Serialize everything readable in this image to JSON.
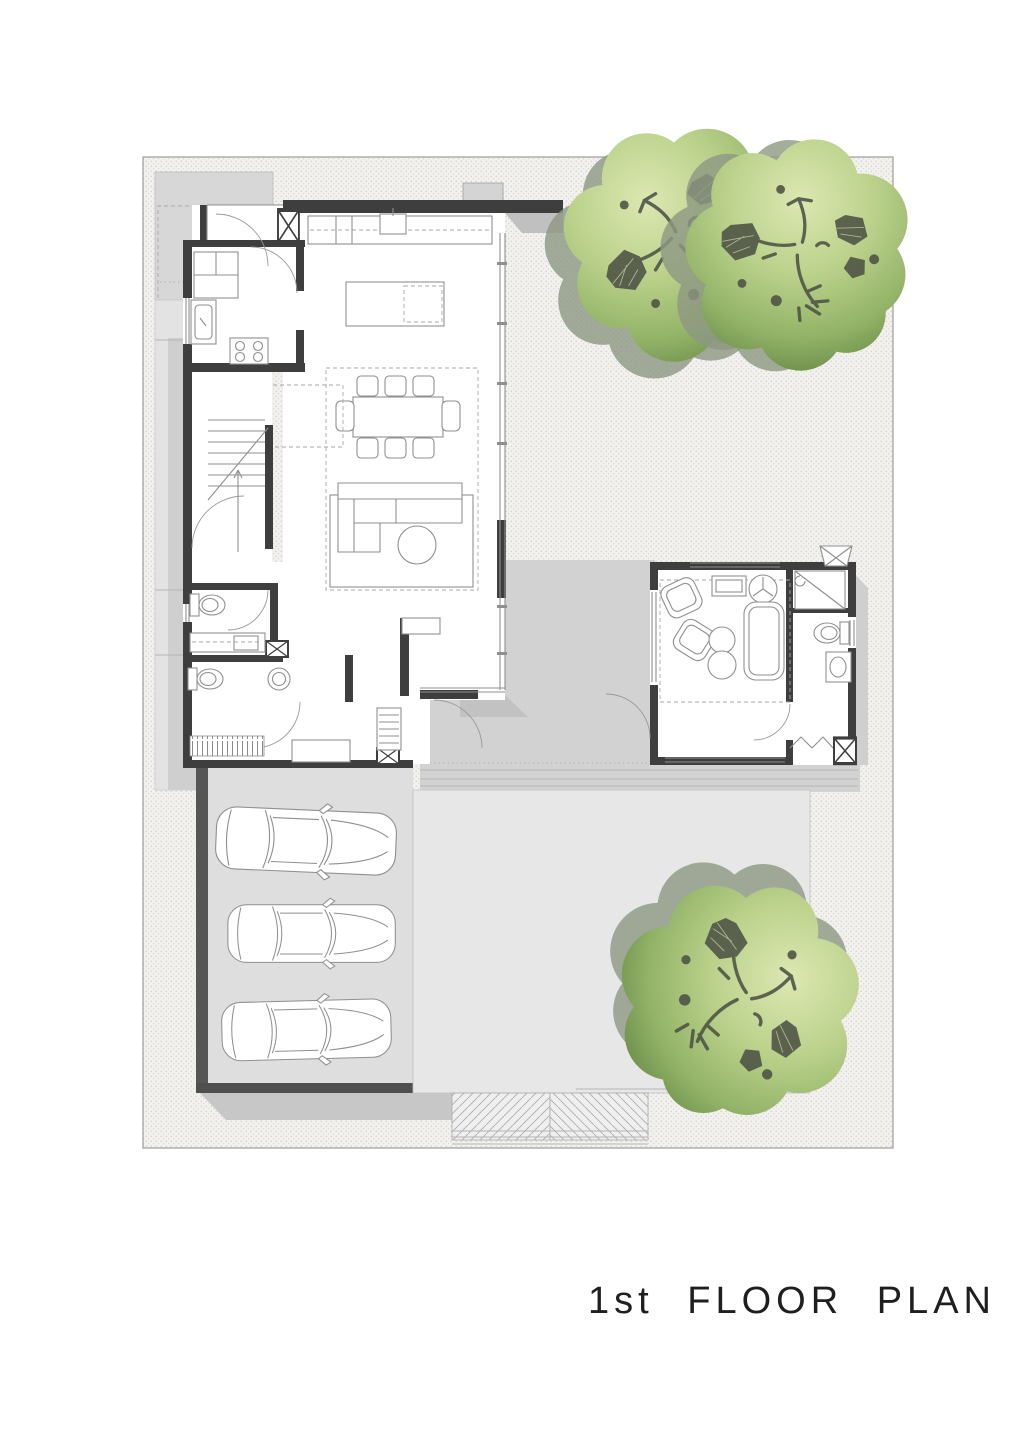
{
  "title": {
    "text": "1st FLOOR PLAN"
  },
  "site": {
    "tree_count": 3,
    "car_count": 3,
    "features": [
      "main-house",
      "guest-pavilion",
      "courtyard-terrace",
      "carport",
      "patio",
      "driveway",
      "trees"
    ]
  },
  "colors": {
    "page_bg": "#ffffff",
    "ink": "#1f1f1f",
    "wall": "#3e3e3e",
    "line": "#8f8f8f",
    "shadow": "#c0c0c0",
    "terrace": "#d7d7d7",
    "courtyard": "#d2d2d2",
    "garage_floor": "#dedede",
    "patio": "#e7e7e7",
    "apron": "#c7c7c7",
    "stipple_bg": "#f2f1ee",
    "stipple_dot": "#c9c9c4",
    "tree_shadow": "#8e9883",
    "branch": "#4d5244",
    "boundary": "#9c9c9c"
  }
}
